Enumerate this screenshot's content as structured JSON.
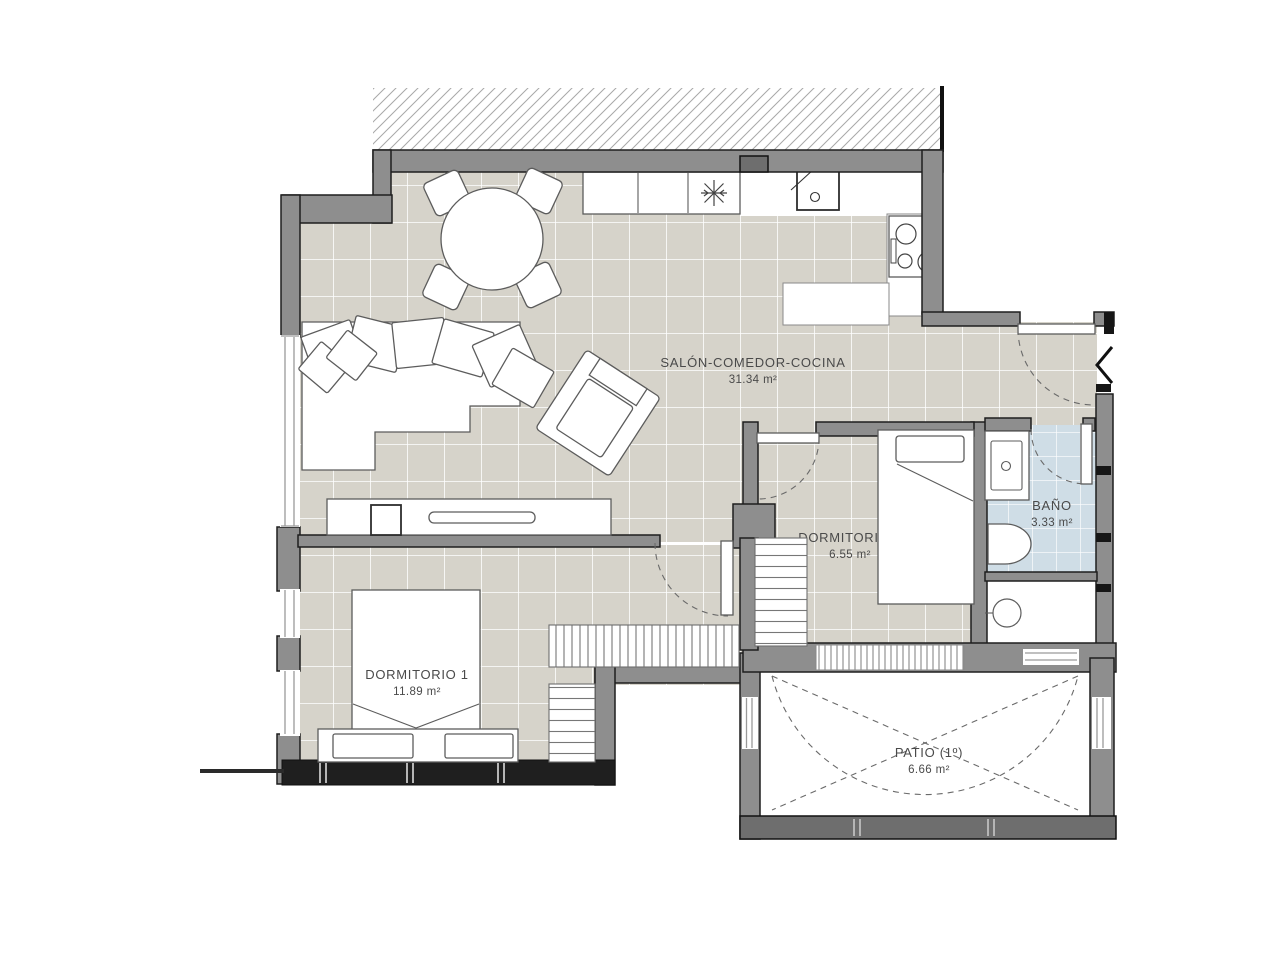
{
  "colors": {
    "floor": "#d6d3ca",
    "bath_floor": "#cfdde6",
    "wall": "#8e8e8e",
    "wall_dark": "#1f1f1f",
    "grout": "#ffffff",
    "hatch": "#a8a8a8",
    "furniture_line": "#5c5c5c",
    "text": "#4a4a4a"
  },
  "rooms": {
    "salon": {
      "name": "SALÓN-COMEDOR-COCINA",
      "area": "31.34 m²"
    },
    "dormitorio2": {
      "name": "DORMITORIO 2",
      "area": "6.55 m²"
    },
    "dormitorio1": {
      "name": "DORMITORIO 1",
      "area": "11.89 m²"
    },
    "bano": {
      "name": "BAÑO",
      "area": "3.33 m²"
    },
    "patio": {
      "name": "PATIO (1º)",
      "area": "6.66 m²"
    }
  }
}
